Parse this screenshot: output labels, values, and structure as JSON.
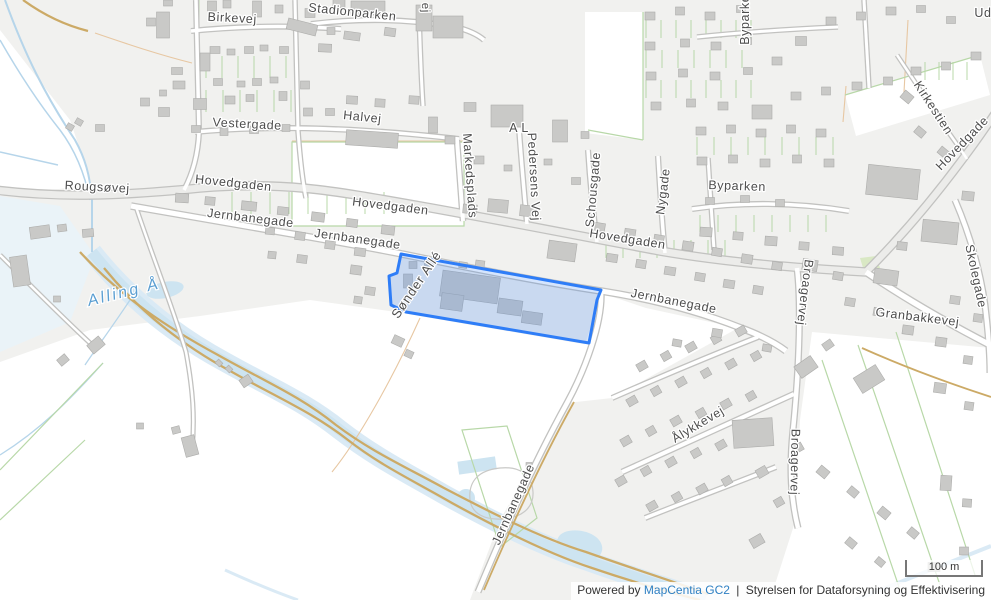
{
  "labels": {
    "birkevej": "Birkevej",
    "stadionparken": "Stadionparken",
    "partial_top": "ej",
    "halvej": "Halvej",
    "vestergade": "Vestergade",
    "markedsplads": "Markedsplads",
    "a_l": "A L",
    "pedersens_vej": "Pedersens Vej",
    "schousgade": "Schousgade",
    "nygade": "Nygade",
    "byparken": "Byparken",
    "byparken_vertical": "Byparken",
    "ud_partial": "Ud",
    "kirkestien": "Kirkestien",
    "hovedgade_ne": "Hovedgade",
    "rougsovej": "Rougsøvej",
    "hovedgaden_w": "Hovedgaden",
    "hovedgaden_m": "Hovedgaden",
    "hovedgaden_e": "Hovedgaden",
    "jernbanegade_w1": "Jernbanegade",
    "jernbanegade_w2": "Jernbanegade",
    "jernbanegade_e": "Jernbanegade",
    "jernbanegade_s": "Jernbanegade",
    "skolegade": "Skolegade",
    "granbakkevej": "Granbakkevej",
    "broagervej_n": "Broagervej",
    "broagervej_s": "Broagervej",
    "alykkevej": "Ålykkevej",
    "alling_a": "Alling Å",
    "sonder_alle": "Sønder Allé"
  },
  "scale": {
    "label": "100 m"
  },
  "attribution": {
    "powered_by": "Powered by",
    "link_label": "MapCentia GC2",
    "separator": "|",
    "agency": "Styrelsen for Dataforsyning og Effektivisering"
  },
  "colors": {
    "land": "#f1f1ef",
    "field": "#ffffff",
    "building": "#c9c9c7",
    "road_casing": "#c2c2c0",
    "road_fill": "#ffffff",
    "water_fill": "#daeaf5",
    "water_line": "#b6d5ea",
    "path_tan": "#ccaa66",
    "parcel_green": "#b8d8a8",
    "parcel_orange": "#e7c7a2",
    "highlight_stroke": "#2e7df7",
    "highlight_fill": "rgba(46,125,247,0.20)",
    "label_color": "#4d4d4d",
    "water_label_color": "#5b9fd2",
    "link_color": "#2f80c3"
  }
}
